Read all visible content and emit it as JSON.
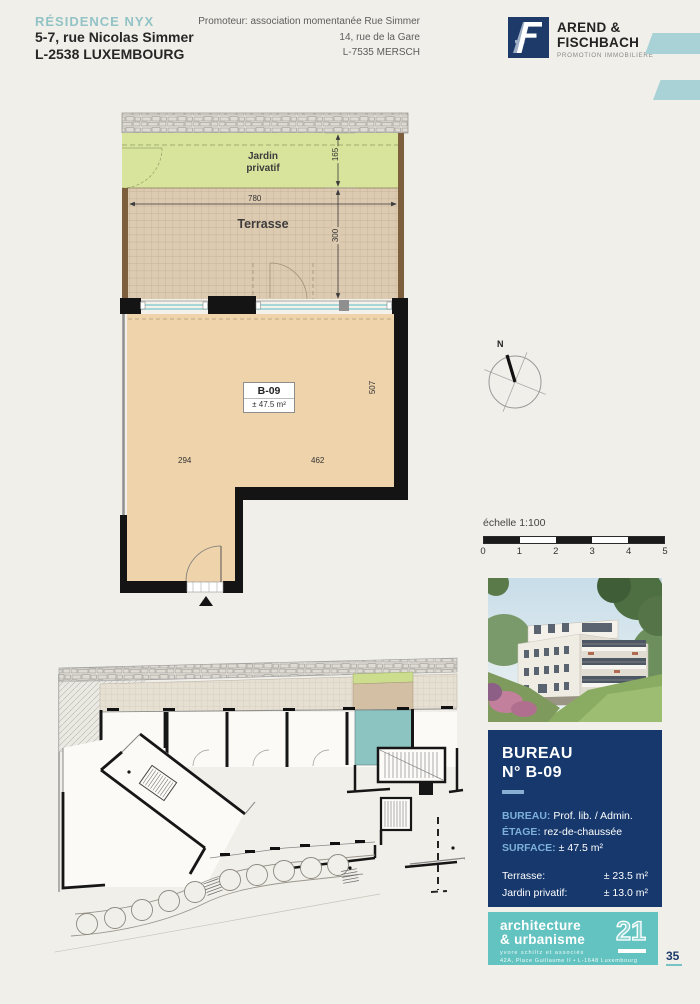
{
  "page": {
    "page_number": "35"
  },
  "header": {
    "residence_name": "RÉSIDENCE NYX",
    "address_line1": "5-7, rue Nicolas Simmer",
    "address_line2": "L-2538 LUXEMBOURG",
    "promoter_line1": "Promoteur: association momentanée Rue Simmer",
    "promoter_line2": "14, rue de la Gare",
    "promoter_line3": "L-7535 MERSCH",
    "logo": {
      "name_line1": "AREND &",
      "name_line2": "FISCHBACH",
      "tagline": "PROMOTION IMMOBILIERE"
    }
  },
  "plan": {
    "jardin_label_line1": "Jardin",
    "jardin_label_line2": "privatif",
    "terrasse_label": "Terrasse",
    "dim_jardin_depth": "165",
    "dim_terrasse_width": "780",
    "dim_terrasse_depth": "300",
    "dim_room_height": "507",
    "dim_room_width_left": "294",
    "dim_room_width_right": "462",
    "unit_code": "B-09",
    "unit_area": "± 47.5 m²",
    "compass_label": "N"
  },
  "scale": {
    "title": "échelle 1:100",
    "ticks": [
      "0",
      "1",
      "2",
      "3",
      "4",
      "5"
    ]
  },
  "info_box": {
    "title_line1": "BUREAU",
    "title_line2": "N° B-09",
    "rows": [
      {
        "label": "BUREAU:",
        "value": "Prof. lib. / Admin."
      },
      {
        "label": "ÉTAGE:",
        "value": "rez-de-chaussée"
      },
      {
        "label": "SURFACE:",
        "value": "± 47.5 m²"
      }
    ],
    "extra_rows": [
      {
        "label": "Terrasse:",
        "value": "± 23.5 m²"
      },
      {
        "label": "Jardin privatif:",
        "value": "± 13.0 m²"
      }
    ]
  },
  "arch_logo": {
    "line1": "architecture",
    "line2": "& urbanisme",
    "number": "21",
    "sub_line1": "yvore schiltz et associés",
    "sub_line2": "42A, Place Guillaume II  •  L-1648 Luxembourg"
  },
  "colors": {
    "accent_teal": "#92c3c6",
    "navy": "#16386c",
    "label_blue": "#7cb0da",
    "logo_teal": "#63c3c1",
    "stripe_teal": "#a9d2d7",
    "jardin_green": "#d8e39c",
    "terrace_tan": "#dccab1",
    "room_beige": "#eed3ab",
    "highlight_teal": "#8cc4c1"
  }
}
